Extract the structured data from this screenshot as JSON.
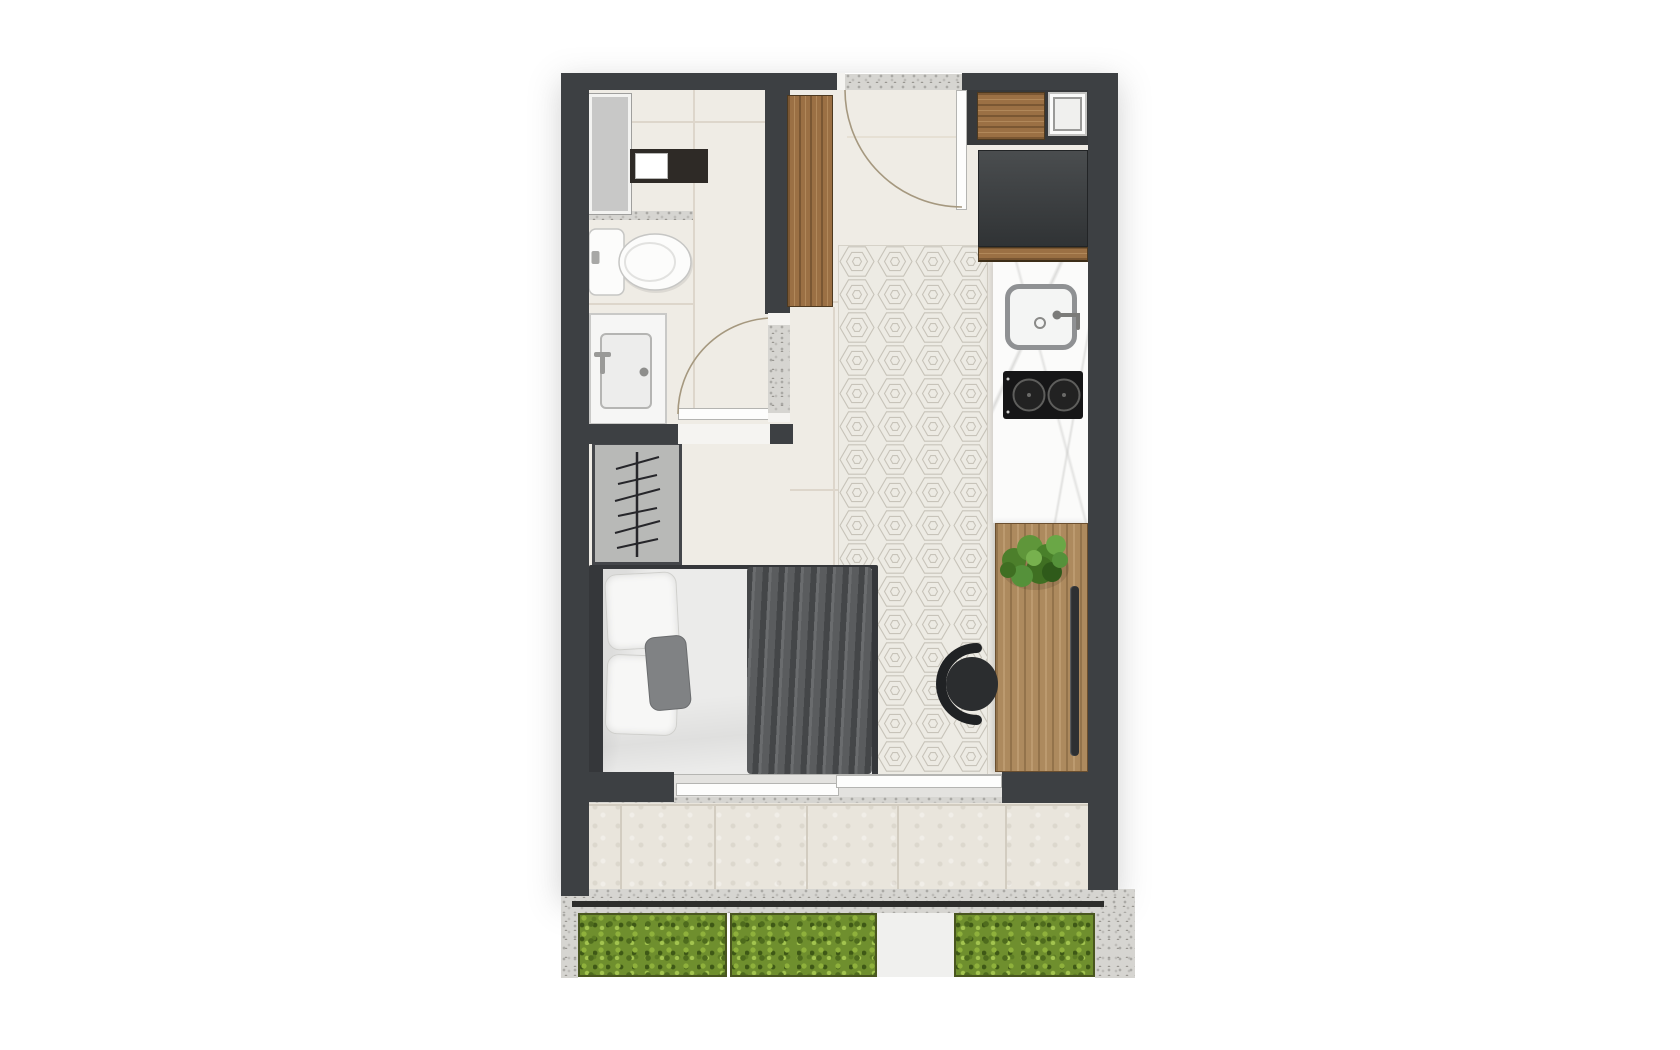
{
  "title": "Studio apartment floor plan",
  "palette": {
    "wall": "#3d4043",
    "floor": "#efece5",
    "tileLine": "#ddd6cb",
    "balcony": "#e9e5dc",
    "counter": "#fbfbfa",
    "fridge_top": "#4a4d4f",
    "fridge_bottom": "#303335",
    "gravel": "#d6d5d1",
    "hedge": "#6f8f2e",
    "fabricDark": "#616365",
    "rugBase": "#edebe4",
    "rugLine": "#c7c3b9",
    "arc": "#a5987f",
    "wood": "#9b7044",
    "woodDesk": "#ad8a5e",
    "chair": "#2b2d2f",
    "plantGreen": "#55913a"
  },
  "objects": {
    "bathroom": [
      "shower-glass-screen",
      "shower-niche",
      "toilet",
      "vanity-sink",
      "bathroom-door"
    ],
    "entry": [
      "entry-threshold",
      "entry-door",
      "wardrobe-panel"
    ],
    "living": [
      "open-closet-with-hangers",
      "double-bed",
      "area-rug",
      "desk-chair"
    ],
    "kitchen": [
      "upper-cabinet",
      "washing-machine",
      "refrigerator",
      "kitchen-counter",
      "kitchen-sink",
      "two-burner-cooktop",
      "wooden-desk",
      "potted-plant"
    ],
    "balcony": [
      "sliding-glass-door",
      "balcony-tiles"
    ],
    "garden": [
      "hedge-left",
      "hedge-center",
      "hedge-right",
      "garden-path",
      "gravel-border"
    ]
  }
}
